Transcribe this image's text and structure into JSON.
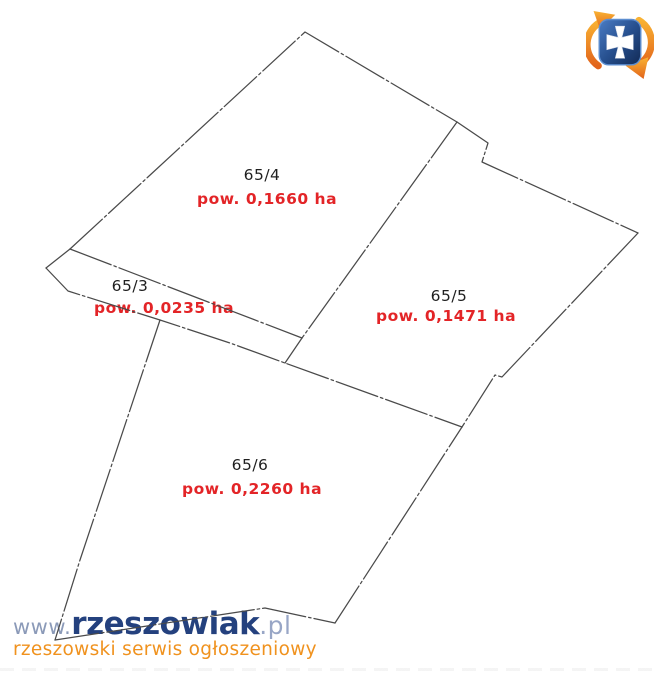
{
  "map": {
    "parcels": [
      {
        "id": "65/4",
        "area_label": "pow. 0,1660 ha"
      },
      {
        "id": "65/3",
        "area_label": "pow. 0,0235 ha"
      },
      {
        "id": "65/5",
        "area_label": "pow. 0,1471 ha"
      },
      {
        "id": "65/6",
        "area_label": "pow. 0,2260 ha"
      }
    ]
  },
  "watermark": {
    "www": "www.",
    "brand": "rzeszowiak",
    "tld": ".pl",
    "tagline": "rzeszowski serwis ogłoszeniowy"
  },
  "colors": {
    "boundary_line": "#4a4a4a",
    "parcel_id_text": "#1f1f1f",
    "area_text_red": "#e32427",
    "brand_navy": "#24417e",
    "brand_light_blue": "#8b9ab8",
    "tld_blue": "#98a6c6",
    "tagline_orange": "#f0921e",
    "logo_shield_blue": "#2a4f8f",
    "logo_arrow_orange": "#f08a1e",
    "logo_cross_white": "#ffffff"
  }
}
